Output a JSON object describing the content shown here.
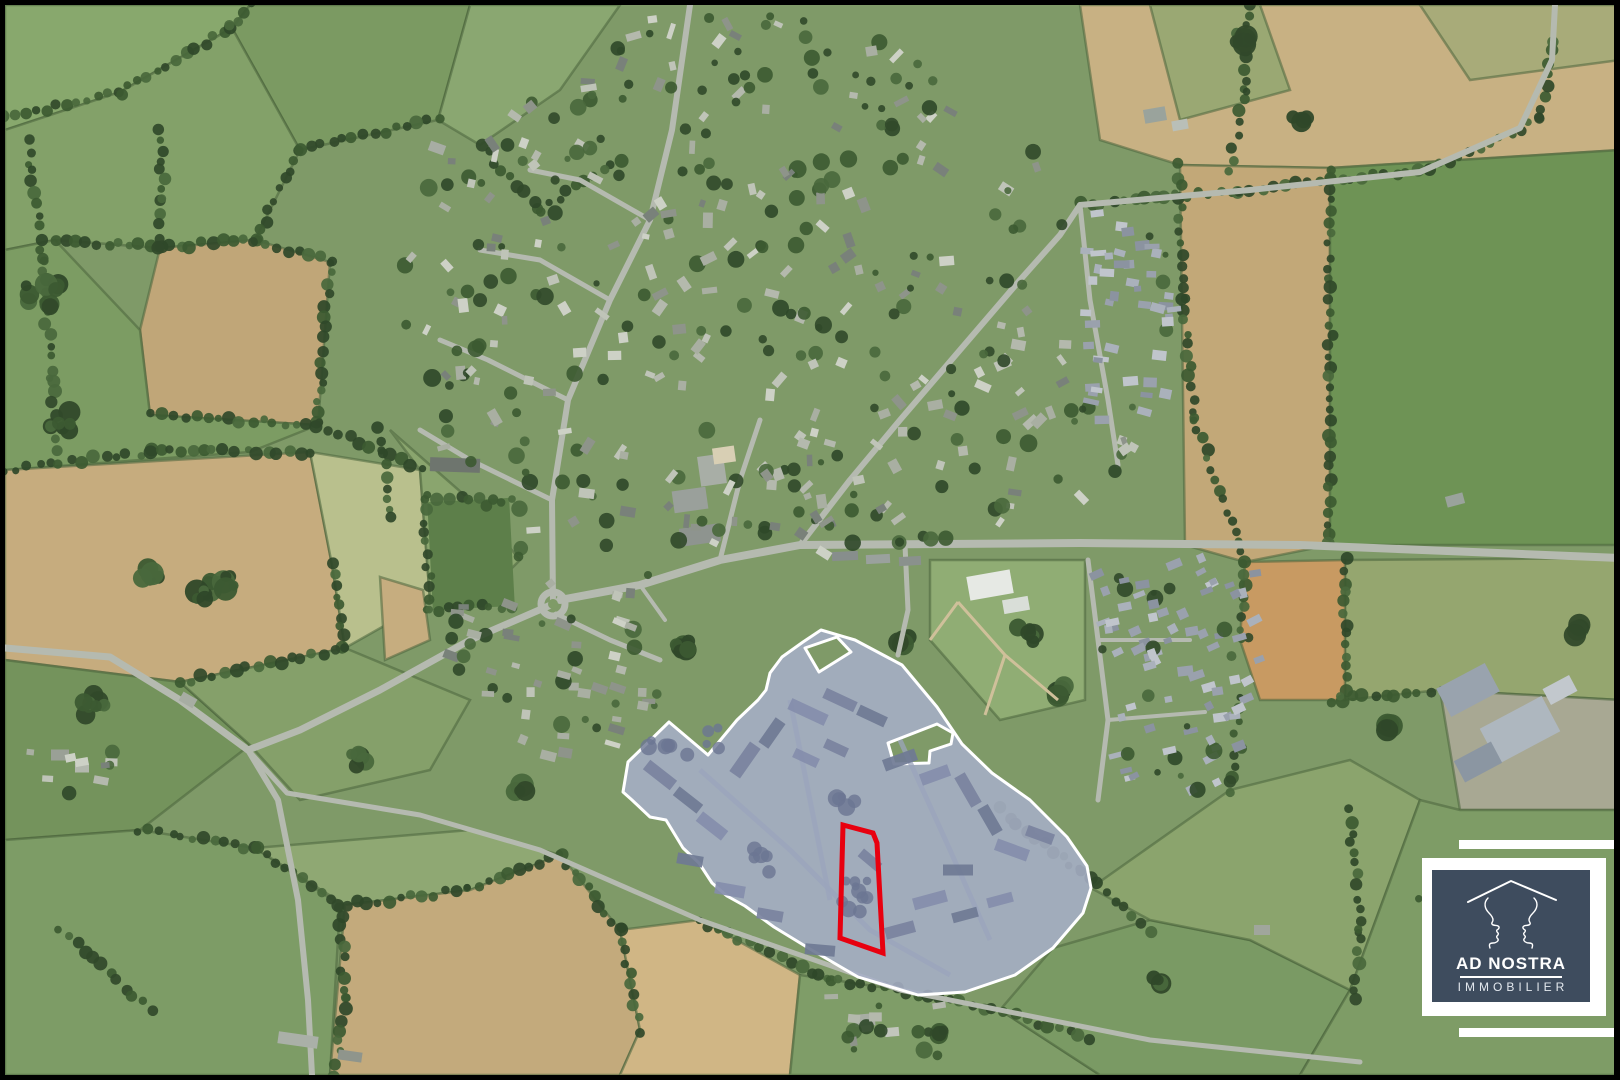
{
  "canvas": {
    "width": 1620,
    "height": 1080,
    "border_color": "#000000",
    "border_width": 5
  },
  "logo": {
    "title": "AD NOSTRA",
    "subtitle": "IMMOBILIER",
    "icon": "roof-and-two-face-profiles",
    "colors": {
      "panel": "#3E4C5E",
      "frame": "#FFFFFF",
      "text": "#FFFFFF"
    }
  },
  "annotations": {
    "site_overlay": {
      "name": "development-zone-overlay",
      "fill": "#A6AEC6",
      "fill_opacity": 0.88,
      "stroke": "#FFFFFF",
      "stroke_width": 3,
      "outer": [
        [
          821,
          630
        ],
        [
          855,
          640
        ],
        [
          902,
          665
        ],
        [
          937,
          707
        ],
        [
          962,
          744
        ],
        [
          992,
          773
        ],
        [
          1030,
          800
        ],
        [
          1067,
          837
        ],
        [
          1087,
          866
        ],
        [
          1091,
          888
        ],
        [
          1083,
          913
        ],
        [
          1053,
          948
        ],
        [
          1015,
          975
        ],
        [
          965,
          992
        ],
        [
          918,
          995
        ],
        [
          858,
          977
        ],
        [
          810,
          949
        ],
        [
          774,
          927
        ],
        [
          745,
          906
        ],
        [
          727,
          896
        ],
        [
          712,
          883
        ],
        [
          699,
          863
        ],
        [
          683,
          848
        ],
        [
          666,
          820
        ],
        [
          650,
          817
        ],
        [
          632,
          800
        ],
        [
          623,
          792
        ],
        [
          628,
          762
        ],
        [
          669,
          722
        ],
        [
          708,
          755
        ],
        [
          737,
          720
        ],
        [
          758,
          700
        ],
        [
          766,
          690
        ],
        [
          770,
          673
        ],
        [
          782,
          657
        ],
        [
          803,
          642
        ]
      ],
      "holes": [
        [
          [
            805,
            648
          ],
          [
            837,
            637
          ],
          [
            851,
            652
          ],
          [
            819,
            672
          ]
        ],
        [
          [
            888,
            743
          ],
          [
            937,
            724
          ],
          [
            953,
            733
          ],
          [
            951,
            744
          ],
          [
            930,
            751
          ],
          [
            929,
            763
          ],
          [
            894,
            764
          ]
        ]
      ]
    },
    "parcel_outline": {
      "name": "highlighted-parcel",
      "stroke": "#E8000F",
      "stroke_width": 5,
      "points": [
        [
          843,
          825
        ],
        [
          873,
          833
        ],
        [
          877,
          843
        ],
        [
          883,
          953
        ],
        [
          840,
          938
        ]
      ]
    }
  }
}
